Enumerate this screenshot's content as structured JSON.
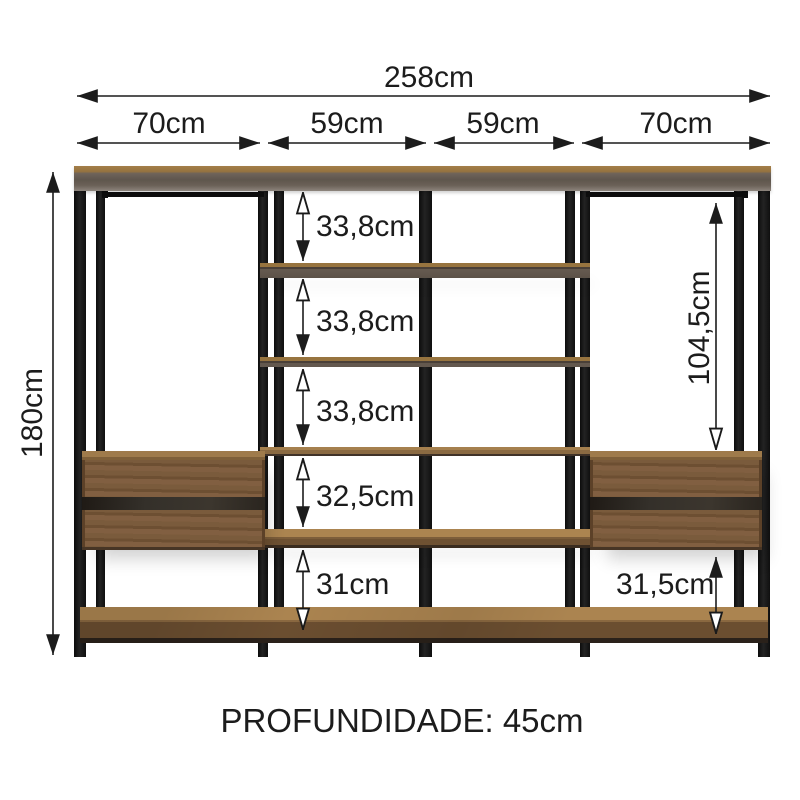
{
  "diagram": {
    "depth_note": "PROFUNDIDADE: 45cm",
    "total_width": "258cm",
    "total_height": "180cm",
    "section_widths": [
      "70cm",
      "59cm",
      "59cm",
      "70cm"
    ],
    "shelf_gaps": [
      "33,8cm",
      "33,8cm",
      "33,8cm",
      "32,5cm",
      "31cm"
    ],
    "hanging_column_height": "104,5cm",
    "bottom_right_gap": "31,5cm",
    "colors": {
      "frame_black": "#151515",
      "wood_front": "#7c5c3a",
      "wood_top": "#a8824f",
      "panel_underside": "#63594f",
      "dimension_ink": "#1c1c1c",
      "background": "#ffffff"
    }
  }
}
